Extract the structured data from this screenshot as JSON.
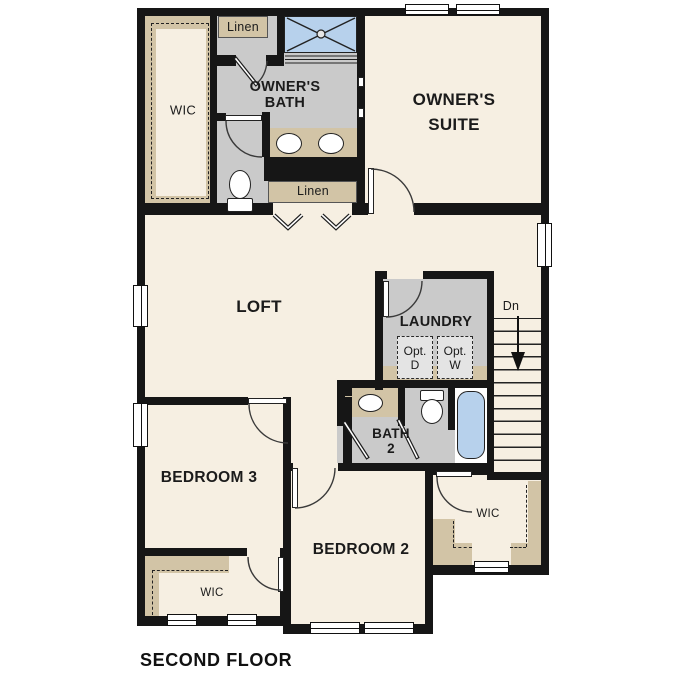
{
  "title": "SECOND FLOOR",
  "colors": {
    "floor": "#f6efe2",
    "wet_room": "#cacaca",
    "shelf": "#d2c4a6",
    "fixture_blue": "#b7d1ec",
    "wall": "#161616",
    "opt_box": "#e4e4e4"
  },
  "rooms": {
    "owners_suite": "OWNER'S\nSUITE",
    "owners_bath": "OWNER'S\nBATH",
    "loft": "LOFT",
    "laundry": "LAUNDRY",
    "bath_2": "BATH\n2",
    "bedroom_2": "BEDROOM 2",
    "bedroom_3": "BEDROOM 3",
    "owners_wic": "WIC",
    "bedroom_2_wic": "WIC",
    "bedroom_3_wic": "WIC",
    "linen_upper": "Linen",
    "linen_lower": "Linen",
    "optional_dryer": "Opt.\nD",
    "optional_washer": "Opt.\nW",
    "stairs_down": "Dn"
  }
}
